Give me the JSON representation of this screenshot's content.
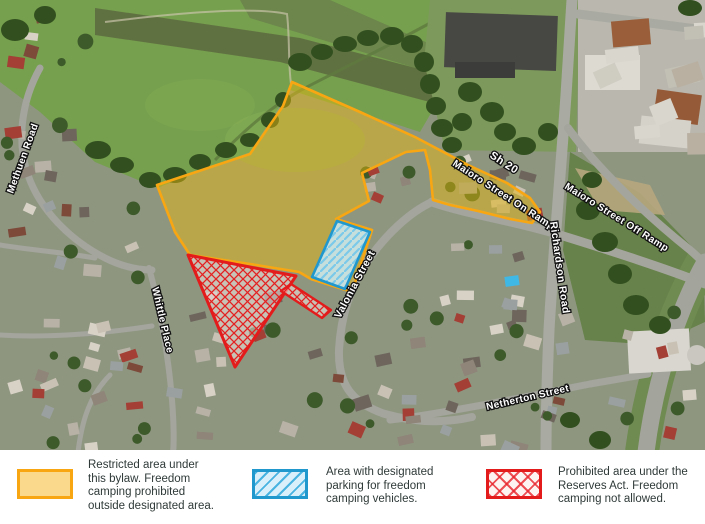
{
  "map": {
    "street_labels": [
      "Methuen Road",
      "Whittle Place",
      "Valonia Street",
      "Sh 20",
      "Maioro Street On Ramp",
      "Maioro Street Off Ramp",
      "Richardson Road",
      "Netherton Street"
    ],
    "areas": [
      {
        "id": "restricted",
        "kind": "Restricted area under this bylaw"
      },
      {
        "id": "parking",
        "kind": "Area with designated parking for freedom camping vehicles"
      },
      {
        "id": "prohibited",
        "kind": "Prohibited area under the Reserves Act"
      }
    ]
  },
  "colors": {
    "restricted_border": "#f8a713",
    "restricted_fill": "#e8b70e",
    "parking_border": "#2097cd",
    "parking_fill": "#c8e8f6",
    "prohibited_border": "#e31b1b",
    "legend_text": "#2f3a38"
  },
  "legend": {
    "items": [
      {
        "id": "restricted",
        "text": "Restricted area under\nthis bylaw. Freedom\ncamping prohibited\noutside designated area."
      },
      {
        "id": "parking",
        "text": "Area with designated\nparking for freedom\ncamping vehicles."
      },
      {
        "id": "prohibited",
        "text": "Prohibited area under the\nReserves Act. Freedom\ncamping not allowed."
      }
    ]
  }
}
